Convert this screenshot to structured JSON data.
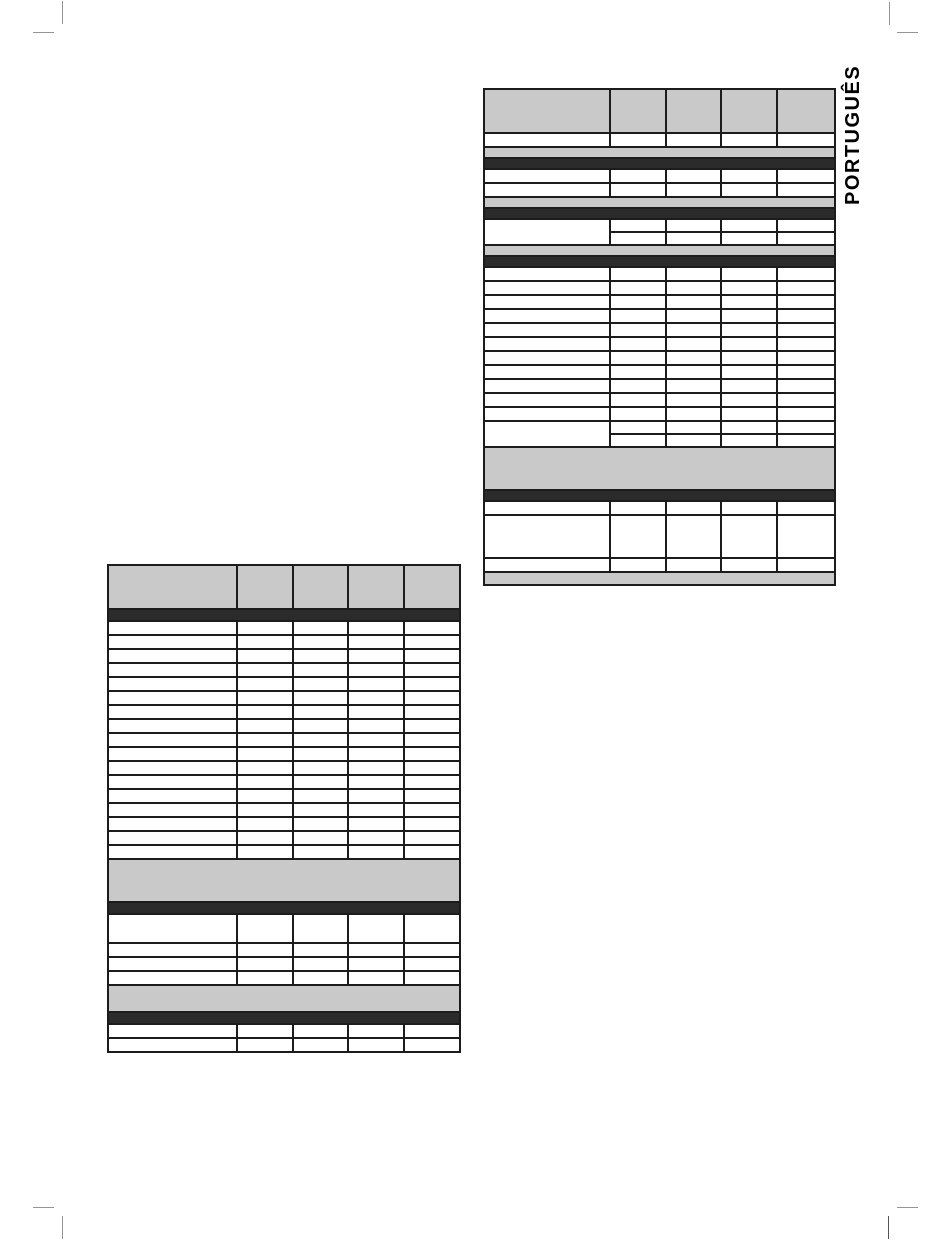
{
  "page": {
    "side_tab_label": "PORTUGUÊS",
    "background": "#ffffff"
  },
  "colors": {
    "band_gray": "#c9c9c9",
    "band_black": "#2b2b2b",
    "table_border": "#1c1c1c",
    "crop_mark": "#949494",
    "label_text": "#000000"
  },
  "tables": {
    "right": {
      "name": "specs-table-right",
      "left": 483,
      "top": 88,
      "width": 351,
      "col_widths": [
        126,
        56,
        55,
        56,
        58
      ],
      "rows": [
        {
          "t": "header",
          "h": 44
        },
        {
          "t": "r",
          "h": 14
        },
        {
          "t": "g",
          "h": 11
        },
        {
          "t": "b",
          "h": 11
        },
        {
          "t": "r",
          "h": 14,
          "n": 2
        },
        {
          "t": "g",
          "h": 11
        },
        {
          "t": "b",
          "h": 11
        },
        {
          "t": "m",
          "h": 13
        },
        {
          "t": "g",
          "h": 11
        },
        {
          "t": "b",
          "h": 11
        },
        {
          "t": "r",
          "h": 14,
          "n": 11
        },
        {
          "t": "m",
          "h": 13
        },
        {
          "t": "g",
          "h": 43
        },
        {
          "t": "b",
          "h": 11
        },
        {
          "t": "r",
          "h": 14
        },
        {
          "t": "r",
          "h": 43
        },
        {
          "t": "r",
          "h": 14
        },
        {
          "t": "g",
          "h": 13
        }
      ]
    },
    "left": {
      "name": "specs-table-left",
      "left": 107,
      "top": 564,
      "width": 352,
      "col_widths": [
        129,
        56,
        55,
        56,
        56
      ],
      "rows": [
        {
          "t": "header",
          "h": 44
        },
        {
          "t": "b",
          "h": 12
        },
        {
          "t": "r",
          "h": 14,
          "n": 17
        },
        {
          "t": "g",
          "h": 43
        },
        {
          "t": "b",
          "h": 12
        },
        {
          "t": "r",
          "h": 29
        },
        {
          "t": "r",
          "h": 14,
          "n": 3
        },
        {
          "t": "g",
          "h": 27
        },
        {
          "t": "b",
          "h": 12
        },
        {
          "t": "r",
          "h": 14,
          "n": 2
        }
      ]
    }
  }
}
